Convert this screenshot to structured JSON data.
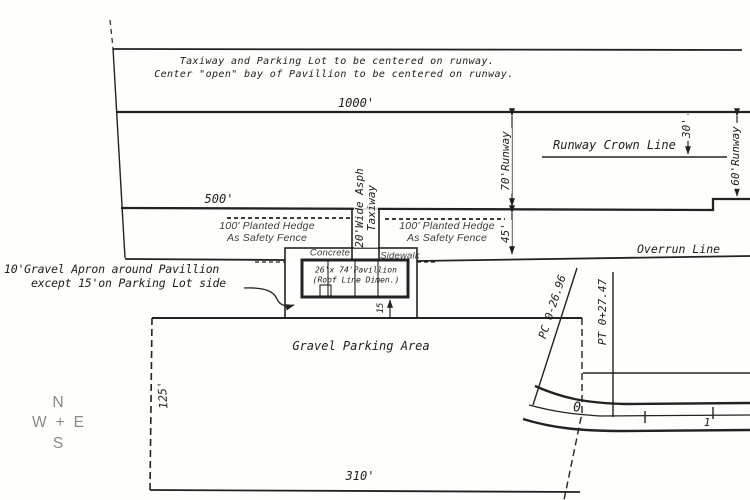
{
  "notes": {
    "centering_line1": "Taxiway and Parking Lot to be centered on runway.",
    "centering_line2": "Center \"open\" bay of Pavillion to be centered on runway.",
    "apron_line1": "10'Gravel Apron around Pavillion",
    "apron_line2": "except 15'on Parking Lot side"
  },
  "dimensions": {
    "top_width": "1000'",
    "mid_width": "500'",
    "runway_width": "70'Runway",
    "runway_width_right": "60'Runway",
    "crown_offset": "30'",
    "overrun_depth": "45'",
    "apron_depth": "15",
    "parking_width": "310'",
    "parking_depth": "125'"
  },
  "labels": {
    "runway_crown": "Runway Crown Line",
    "overrun": "Overrun Line",
    "hedge_line1": "100' Planted Hedge",
    "hedge_line2": "As Safety Fence",
    "taxiway_line1": "20'Wide Asph",
    "taxiway_line2": "Taxiway",
    "concrete": "Concrete",
    "sidewalk": "Sidewalk",
    "pavilion_line1": "26'x 74'Pavillion",
    "pavilion_line2": "(Roof Line Dimen.)",
    "parking_area": "Gravel Parking Area",
    "pc_station": "PC 0-26.96",
    "pt_station": "PT 0+27.47",
    "station_0": "0",
    "station_1": "1"
  },
  "compass": {
    "north": "N",
    "west": "W",
    "plus": "+",
    "east": "E",
    "south": "S"
  },
  "colors": {
    "ink": "#222222",
    "hedge_ink": "#3c3c3c",
    "compass_gray": "#8a8a8a",
    "paper": "#fefefd"
  }
}
